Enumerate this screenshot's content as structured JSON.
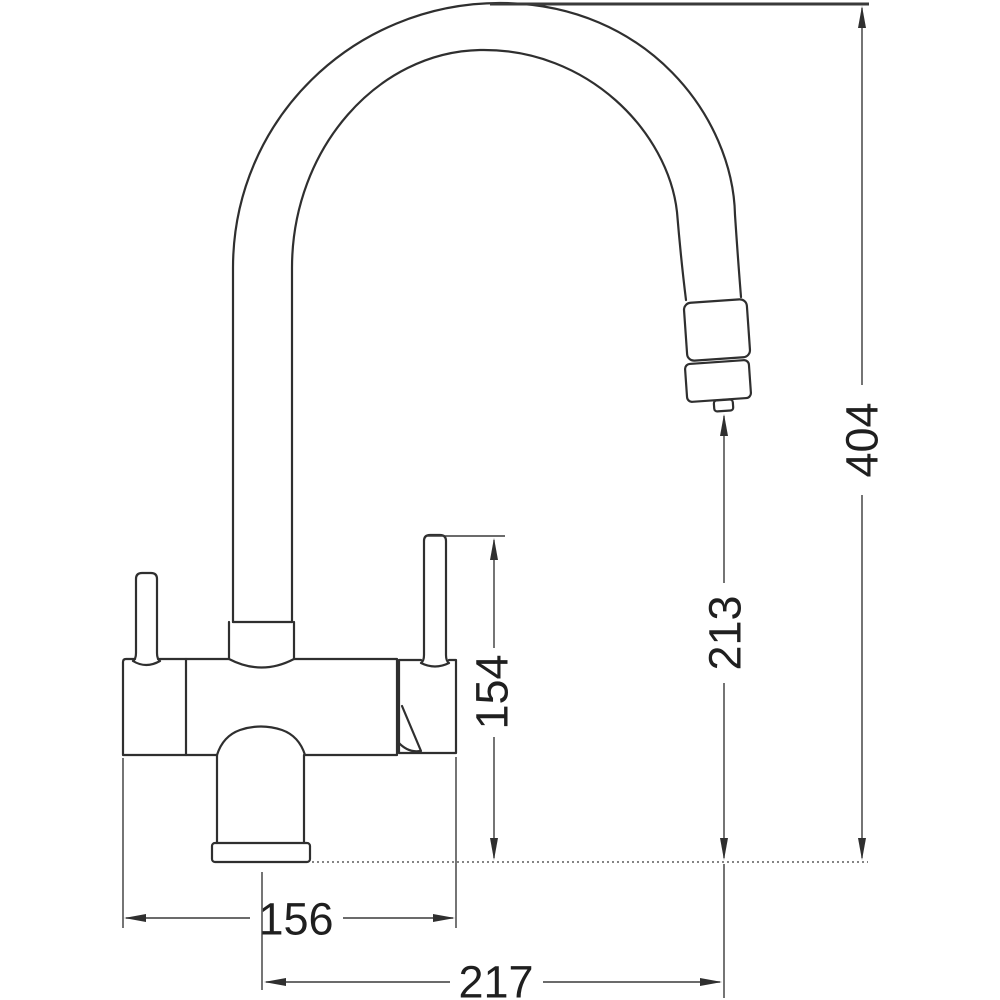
{
  "dimensions": {
    "total_height": "404",
    "outlet_height": "213",
    "lever_height": "154",
    "base_width": "156",
    "spout_reach": "217"
  },
  "colors": {
    "line": "#2f2f2f",
    "dimension_line": "#3a3a3a",
    "text": "#1f1f1f",
    "background": "#ffffff"
  }
}
